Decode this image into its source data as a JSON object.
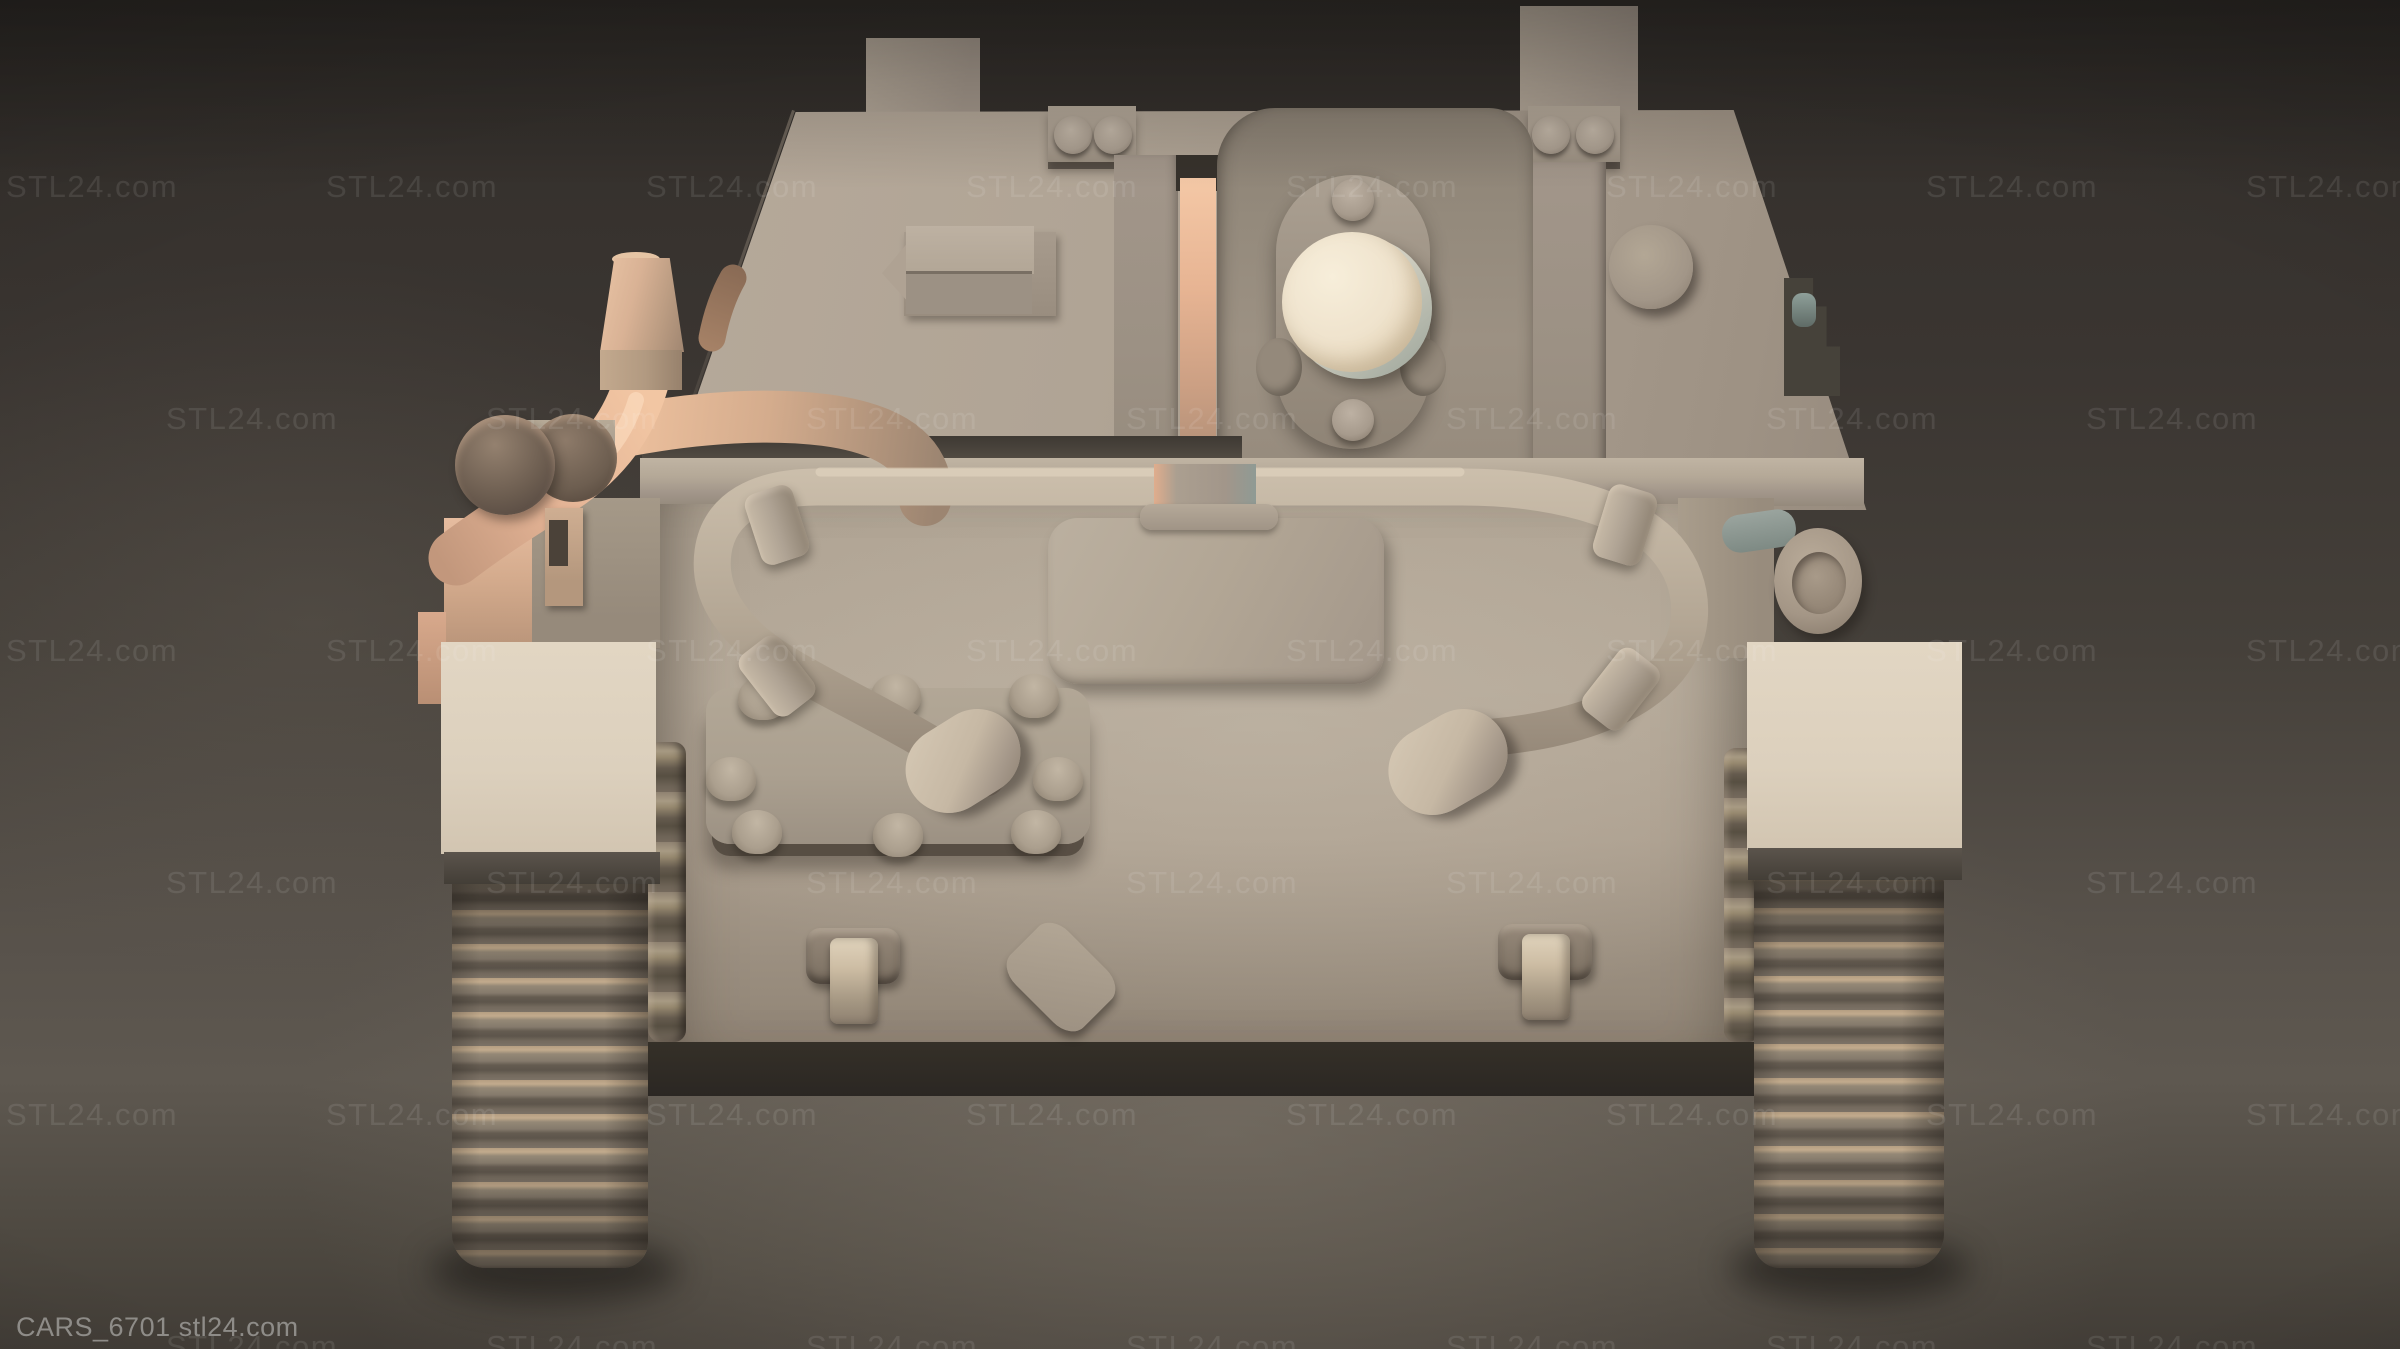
{
  "meta": {
    "title": "CARS_6701 tank 3D model render preview",
    "type": "3d-render-preview",
    "subject": "Beige 3D-printable tank model, gun front view, dark studio backdrop"
  },
  "watermark": {
    "text": "STL24.com",
    "font_size": 31,
    "opacity": 0.09,
    "color": "#ffffff",
    "row_y": [
      185,
      417,
      649,
      881,
      1113,
      1345
    ],
    "row_x_offsets": [
      6,
      166,
      6,
      166,
      6,
      166
    ],
    "x_spacing": 320,
    "per_row": 8
  },
  "footer": {
    "label": "CARS_6701 stl24.com",
    "color": "#8e8c88"
  },
  "palette": {
    "bg_top": "#322e2a",
    "bg_mid": "#45403a",
    "bg_floor": "#6e675e",
    "bg_edge": "#2b2724",
    "beige_light": "#ded2bf",
    "beige": "#b2a696",
    "beige_mid": "#a2968a",
    "beige_dark": "#948878",
    "beige_deep": "#847768",
    "track_brown": "#766b5e",
    "band_dark": "#2e2a26",
    "salmon": "#f0c4a2",
    "salmon_deep": "#c89c80",
    "muzzle_cream": "#efe3cf",
    "cool_gray": "#97a09b",
    "metal_bright": "#d9ccb6",
    "label_color": "#8e8c88"
  },
  "scene": {
    "parts": [
      "hull",
      "superstructure",
      "gun-mantlet",
      "gun-muzzle",
      "tow-cable",
      "exhaust-pipes",
      "left-track",
      "right-track",
      "fenders",
      "bolt-plate",
      "access-hatch"
    ]
  }
}
